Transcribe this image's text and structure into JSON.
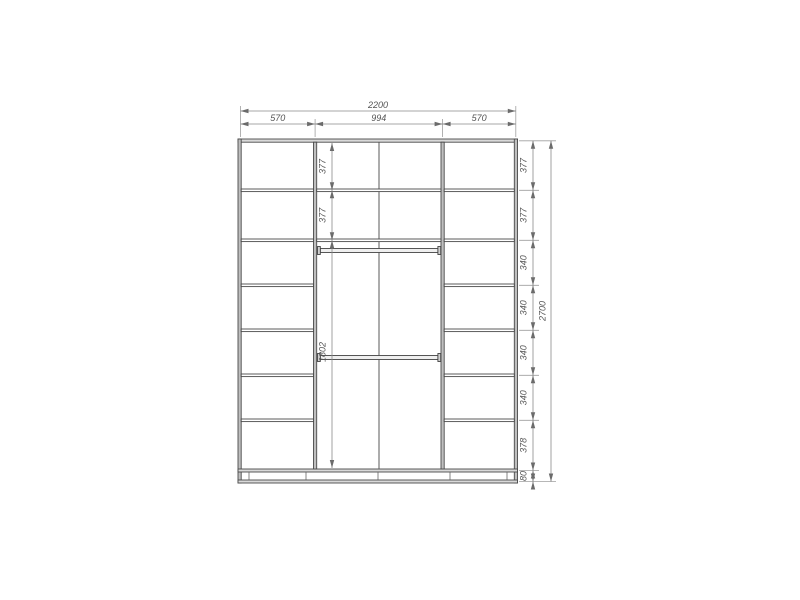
{
  "drawing": {
    "type": "wardrobe-front-elevation",
    "dimensions": {
      "overall_width": "2200",
      "overall_height": "2700",
      "top_sections": [
        "570",
        "994",
        "570"
      ],
      "right_chain": [
        "377",
        "377",
        "340",
        "340",
        "340",
        "340",
        "378",
        "80"
      ],
      "middle_chain": [
        "377",
        "377",
        "1802"
      ]
    },
    "colors": {
      "background": "#ffffff",
      "line": "#4a4a4a",
      "panel_fill": "#d9d9d9",
      "partition_fill": "#bfbfbf",
      "dimension_line": "#8a8a8a",
      "dimension_text": "#555555"
    }
  }
}
